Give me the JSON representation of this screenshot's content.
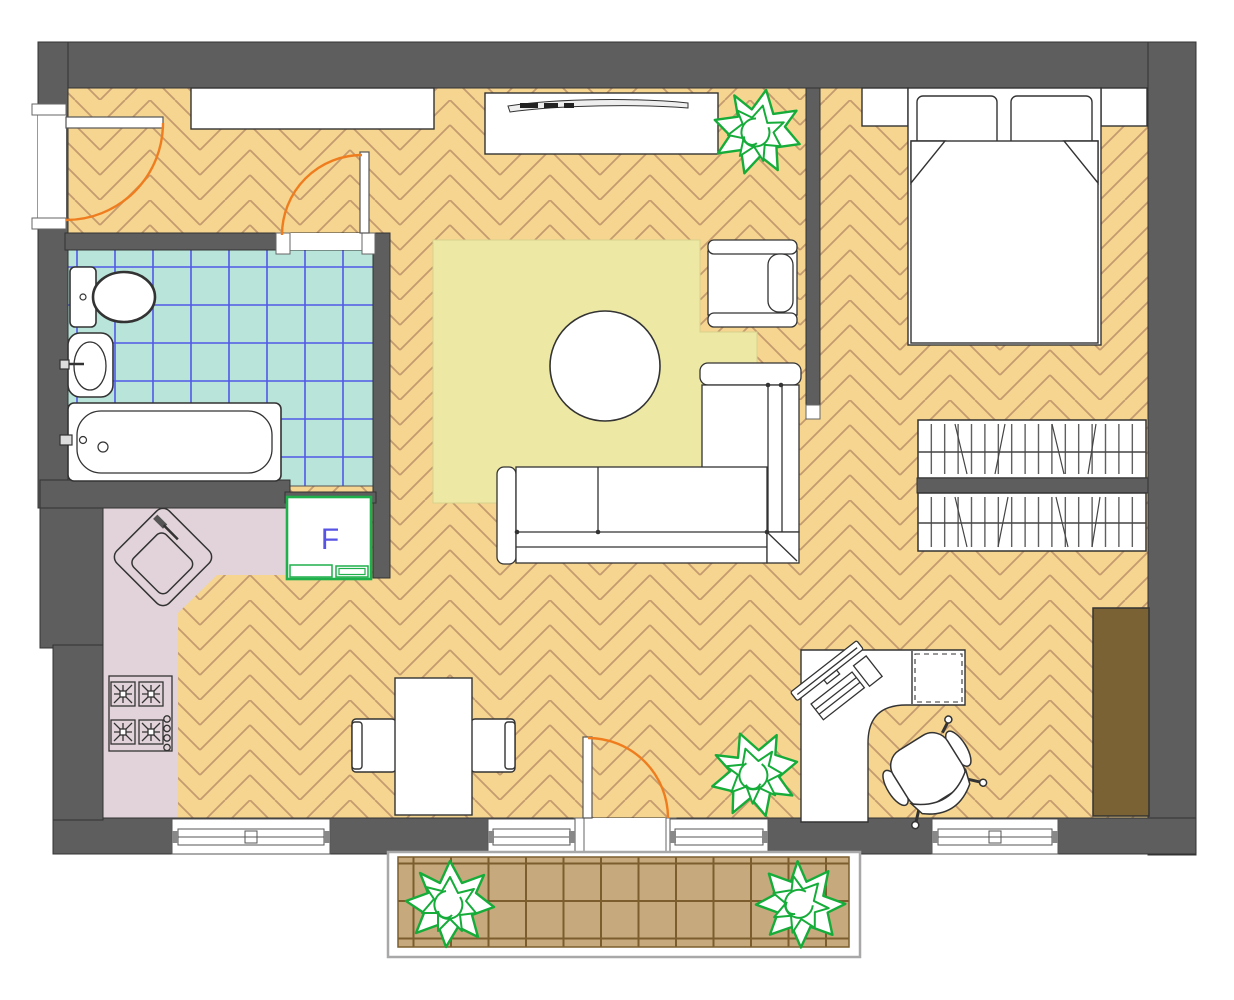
{
  "palette": {
    "wall": "#5e5e5e",
    "wall_edge": "#333333",
    "floor_parquet": "#f5d58f",
    "parquet_line": "#c49b70",
    "bath_tile": "#b9e4d9",
    "bath_tile_line": "#5059e8",
    "kitchen_floor": "#e1d3d9",
    "rug": "#ede9a5",
    "balcony_tile": "#c6a97c",
    "balcony_tile_line": "#7c5e2e",
    "furniture": "#ffffff",
    "furniture_line": "#333333",
    "door_arc": "#ef7d1f",
    "plant_green": "#16ac3a",
    "fridge_green": "#1faf4b",
    "fridge_letter": "#5753e3",
    "wardrobe_brown": "#7b6234"
  },
  "labels": {
    "fridge": "F"
  }
}
